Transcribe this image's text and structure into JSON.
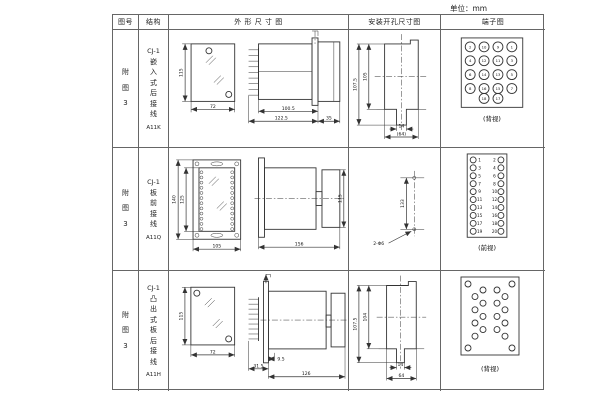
{
  "page": {
    "unit_label": "单位：mm"
  },
  "header": {
    "fig_no": "图号",
    "structure": "结构",
    "outline": "外 形 尺 寸 图",
    "install": "安装开孔尺寸图",
    "terminal": "端子图"
  },
  "rows": [
    {
      "fig_no": "附图3",
      "model": "CJ-1",
      "structure": "嵌入式后接线",
      "code": "A11K",
      "outline": {
        "front_height": "115",
        "front_width": "72",
        "depth_1": "100.5",
        "depth_2": "122.5",
        "cover": "35"
      },
      "install": {
        "height_outer": "107.5",
        "height_inner": "105",
        "notch_width": "14",
        "total_width": "(64)"
      },
      "terminal": {
        "caption": "(背视)",
        "grid": [
          [
            "2",
            "10",
            "9",
            "1"
          ],
          [
            "4",
            "12",
            "11",
            "3"
          ],
          [
            "6",
            "14",
            "13",
            "5"
          ],
          [
            "8",
            "16",
            "15",
            "7"
          ],
          [
            "18",
            "17"
          ]
        ]
      }
    },
    {
      "fig_no": "附图3",
      "model": "CJ-1",
      "structure": "板前接线",
      "code": "A11Q",
      "outline": {
        "front_height_outer": "140",
        "front_height_inner": "125",
        "front_width": "105",
        "depth": "156",
        "side_height": "115"
      },
      "install": {
        "hole_spacing": "133",
        "hole_label": "2-Φ6"
      },
      "terminal": {
        "caption": "(前视)",
        "left_column": [
          "1",
          "3",
          "5",
          "7",
          "9",
          "11",
          "13",
          "15",
          "17",
          "19"
        ],
        "right_column": [
          "2",
          "4",
          "6",
          "8",
          "10",
          "12",
          "14",
          "16",
          "18",
          "20"
        ]
      }
    },
    {
      "fig_no": "附图3",
      "model": "CJ-1",
      "structure": "凸出式板后接线",
      "code": "A11H",
      "outline": {
        "front_height": "115",
        "front_width": "72",
        "pin_depth": "31.5",
        "panel_gap": "9.5",
        "depth": "126"
      },
      "install": {
        "height_outer": "107.5",
        "height_inner": "104",
        "notch_width": "14",
        "total_width": "64"
      },
      "terminal": {
        "caption": "(背视)",
        "corner_holes": 4,
        "left_count": 8,
        "right_count": 8
      }
    }
  ]
}
